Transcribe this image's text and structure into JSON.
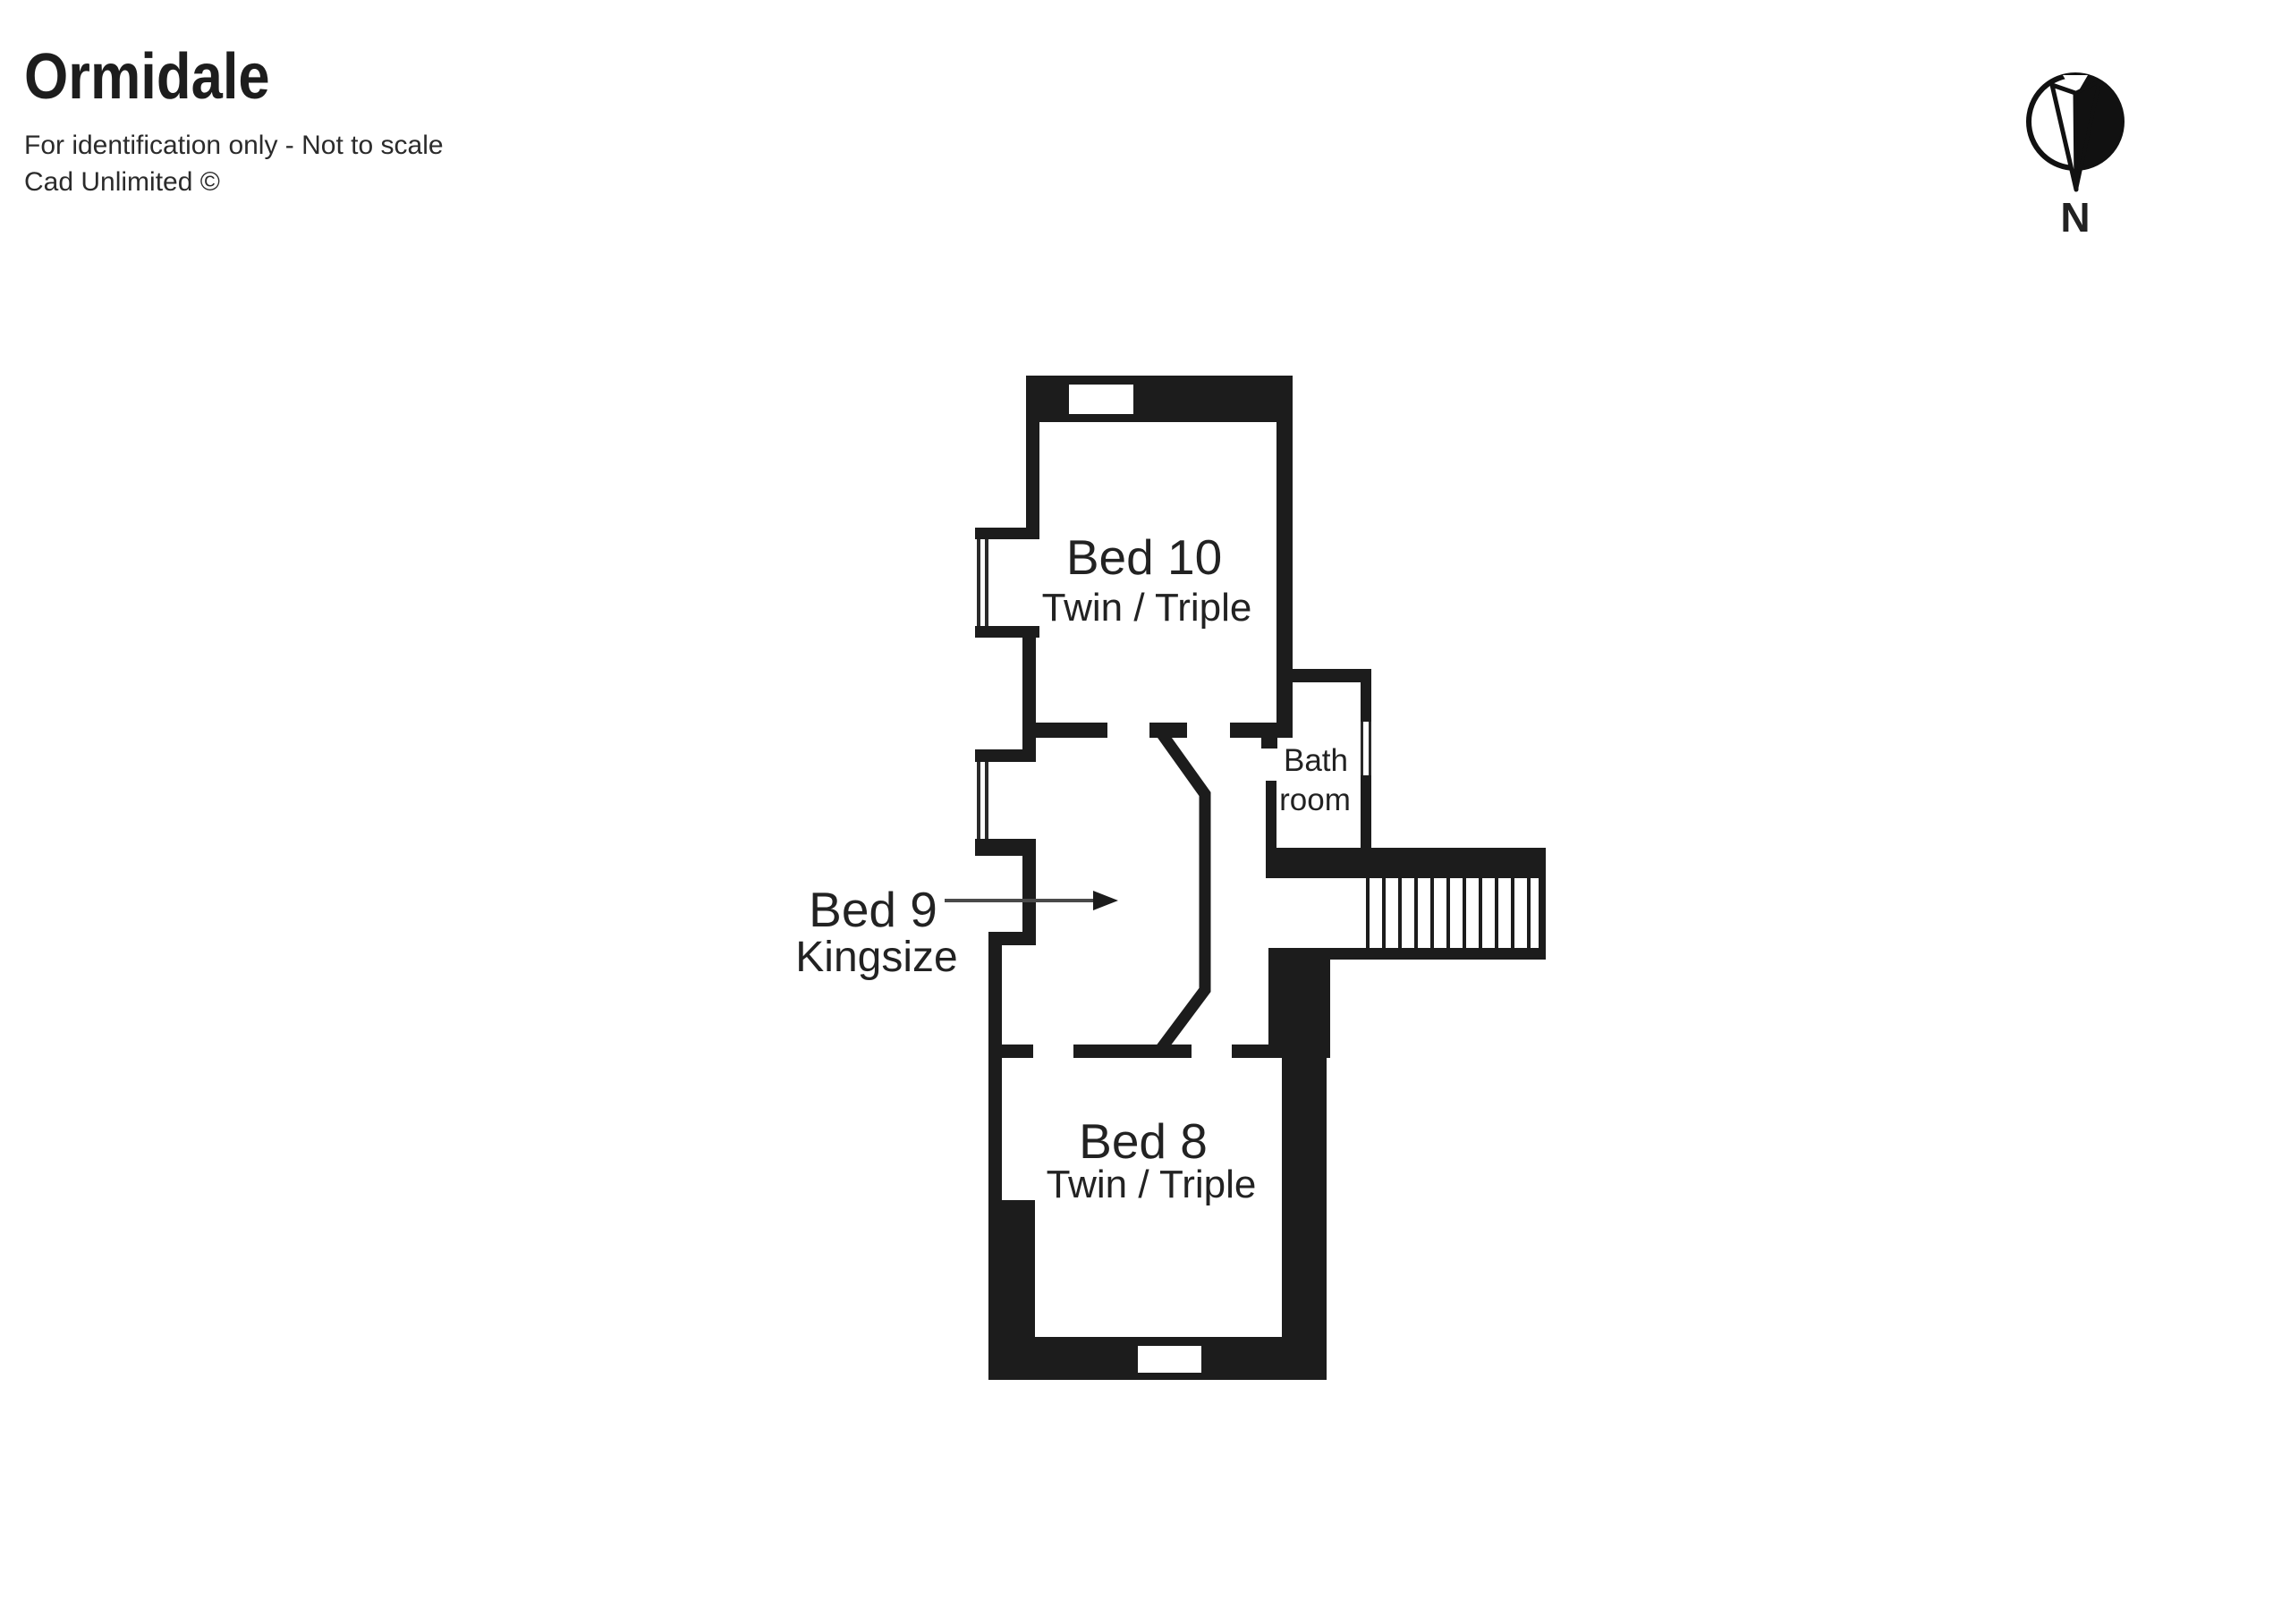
{
  "header": {
    "title": "Ormidale",
    "subtitle": "For identification only - Not to scale",
    "credit": "Cad Unlimited ©"
  },
  "compass": {
    "label": "N"
  },
  "rooms": {
    "bed10": {
      "name": "Bed 10",
      "type": "Twin / Triple"
    },
    "bed9": {
      "name": "Bed 9",
      "type": "Kingsize"
    },
    "bed8": {
      "name": "Bed 8",
      "type": "Twin / Triple"
    },
    "bathroom": {
      "line1": "Bath",
      "line2": "room"
    }
  },
  "features": {
    "stairs": "staircase",
    "pointer": "arrow from Bed 9 label into room"
  },
  "colors": {
    "wall": "#1c1c1c",
    "text": "#222222",
    "arrow": "#4a4a4a",
    "background": "#ffffff"
  }
}
